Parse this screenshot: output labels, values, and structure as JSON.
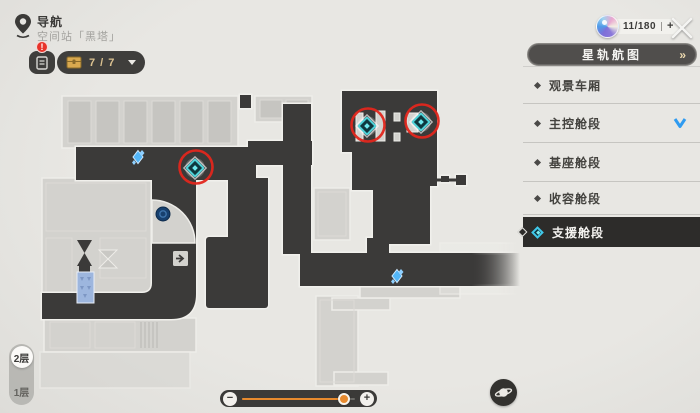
{
  "header": {
    "nav_title": "导航",
    "location": "空间站「黑塔」",
    "tracker_badge": "!",
    "chest_count": "7 / 7",
    "currency_count": "11/180",
    "currency_plus": "+"
  },
  "sidebar": {
    "header_label": "星轨航图",
    "header_arrow": "»",
    "items": [
      {
        "label": "观景车厢",
        "selected": false,
        "current": false
      },
      {
        "label": "主控舱段",
        "selected": false,
        "current": true
      },
      {
        "label": "基座舱段",
        "selected": false,
        "current": false
      },
      {
        "label": "收容舱段",
        "selected": false,
        "current": false
      },
      {
        "label": "支援舱段",
        "selected": true,
        "current": false
      }
    ]
  },
  "floors": {
    "items": [
      {
        "label": "2层",
        "selected": true
      },
      {
        "label": "1层",
        "selected": false
      }
    ]
  },
  "zoom_slider": {
    "minus": "−",
    "plus": "+",
    "value_pct": 90
  },
  "map": {
    "teleport_markers": [
      {
        "x": 195,
        "y": 168,
        "circled": true
      },
      {
        "x": 367,
        "y": 126,
        "circled": true
      },
      {
        "x": 421,
        "y": 122,
        "circled": true
      }
    ],
    "item_markers": [
      {
        "x": 138,
        "y": 157
      },
      {
        "x": 397,
        "y": 276
      }
    ],
    "colors": {
      "corridor": "#3b3a39",
      "structure": "#d3d2ce",
      "outline": "#f1f0ec",
      "highlight_red": "#e2261c",
      "teleport_teal": "#4fd2d8",
      "item_blue": "#52b5f7",
      "accent_orange": "#e78a2e"
    }
  }
}
